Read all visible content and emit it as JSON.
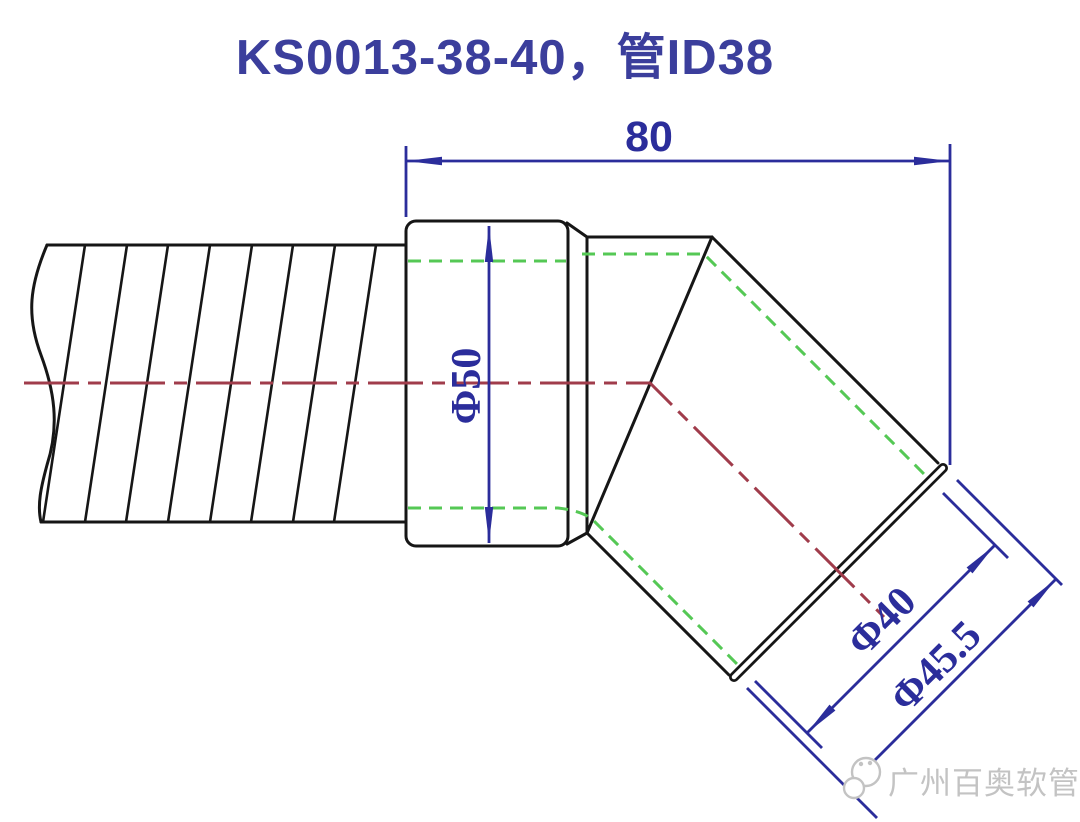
{
  "title": "KS0013-38-40，管ID38",
  "dimensions": {
    "overall_length": "80",
    "cuff_diameter": "Φ50",
    "pipe_diameter": "Φ40",
    "end_diameter": "Φ45.5"
  },
  "watermark": {
    "text": "广州百奥软管",
    "logo": "chat-bubbles-icon"
  },
  "colors": {
    "dim-blue": "#2b2d9b",
    "title-blue": "#3b3e9c",
    "hidden-green": "#55c855",
    "center-red": "#a03c4b",
    "outline-black": "#161616",
    "watermark-gray": "#c3c3c3",
    "background": "#ffffff"
  }
}
